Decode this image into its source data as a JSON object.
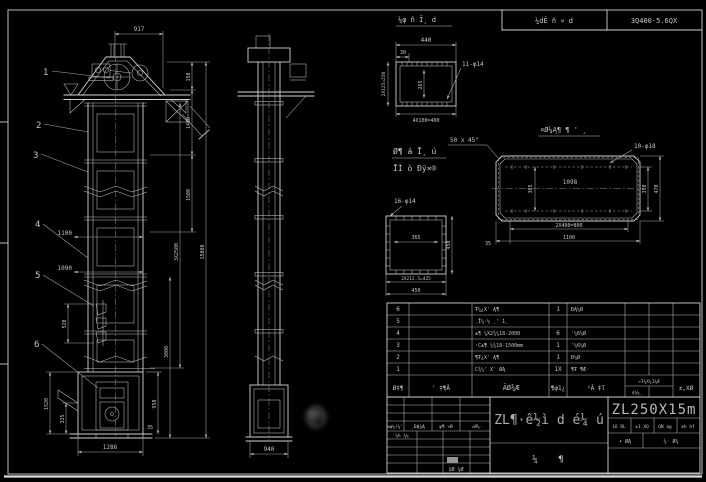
{
  "frame": {
    "strip_left": "¼dÊ ñ » d",
    "strip_right": "3Q400-5.6QX"
  },
  "balloons": {
    "b1": "1",
    "b2": "2",
    "b3": "3",
    "b4": "4",
    "b5": "5",
    "b6": "6"
  },
  "front": {
    "d917": "917",
    "d150": "150",
    "d1480": "1480",
    "d1500": "1500",
    "d3x2500": "3X2500",
    "d15000": "15000",
    "d3000": "3000",
    "d950": "950",
    "d1520": "1520",
    "d325": "325",
    "d520": "520",
    "d1100": "1100",
    "d1090": "1090",
    "d1286": "1286",
    "d35": "35"
  },
  "side": {
    "d940": "940"
  },
  "detail_head": {
    "title": "¼φ ñ Ī¸ d",
    "d440": "440",
    "d30": "30",
    "holes": "11-φ14",
    "d_col": "2X125=250",
    "d_row": "4X100=400",
    "d_inner": "265"
  },
  "notes": {
    "line1": "Ø¶ á Ī¸ ú",
    "line2": "ĪÌ ò Đỹ×®",
    "chamfer": "50 x 45°"
  },
  "detail_square": {
    "holes": "16-φ14",
    "d_inner": "365",
    "d_right": "450",
    "d_b1": "2X212.5=425",
    "d_b2": "450"
  },
  "detail_long": {
    "title": "¤Ø¼Ą¶ ¶ ' ¸",
    "holes": "10-φ18",
    "d_inner": "1098",
    "d_v_in": "365",
    "d_v1": "350",
    "d_v2": "470",
    "d_b1": "2X400=800",
    "d_b2": "1100",
    "d_35": "35"
  },
  "bom": {
    "headers": {
      "h1": "Ø‡¶",
      "h2": "' ‡¶Ă",
      "h3": "ĂØ¾Æ",
      "h4": "¶φ1¿",
      "h5": "²Ă ‡T",
      "h6": "¤Ŧ¼X¼1¾Æ",
      "h7": "¢¾¼¸",
      "h8": "±,XØ"
    },
    "rows": [
      {
        "no": "6",
        "desc": "Ŧ¼¿X' Ą¶",
        "qty": "1",
        "mat": "ĐĄ¼Ø"
      },
      {
        "no": "5",
        "desc": "¸Ī¼·½ ¸' 1¸",
        "qty": "",
        "mat": ""
      },
      {
        "no": "4",
        "desc": "±¶ ¼X2¾¼18-2000",
        "qty": "6",
        "mat": "'¼6¼Ø"
      },
      {
        "no": "3",
        "desc": "·C±¶ ¼¾18-1500mm",
        "qty": "1",
        "mat": "'¼6¼Ø"
      },
      {
        "no": "2",
        "desc": "¶Ŧ¿X' Ą¶",
        "qty": "1",
        "mat": "Đ¼Ø"
      },
      {
        "no": "1",
        "desc": "C¾¼' X' ØĄ",
        "qty": "1X",
        "mat": "¶Ŧ ¶Æ·"
      }
    ]
  },
  "title_block": {
    "name": "ZL¶·ê½ì d é¼ ú",
    "number": "ZL250X15m",
    "name_sub1": "¼",
    "name_sub2": "¶",
    "rev_h1": "±φ¼(¼'",
    "rev_h2": "¸ĐĄ¼Ą",
    "rev_h3": "φ¶ ×Ø",
    "rev_h4": "»Ø¼·",
    "rev_row": "¼h ¾¼",
    "rev_note": "‡Ø ¼Ø",
    "c1": "16 RL",
    "c2": "±1 XQ",
    "c3": "QN ag",
    "c4": "±h hf",
    "m1": "• ØĄ",
    "m2": "¼· Ø¼"
  }
}
